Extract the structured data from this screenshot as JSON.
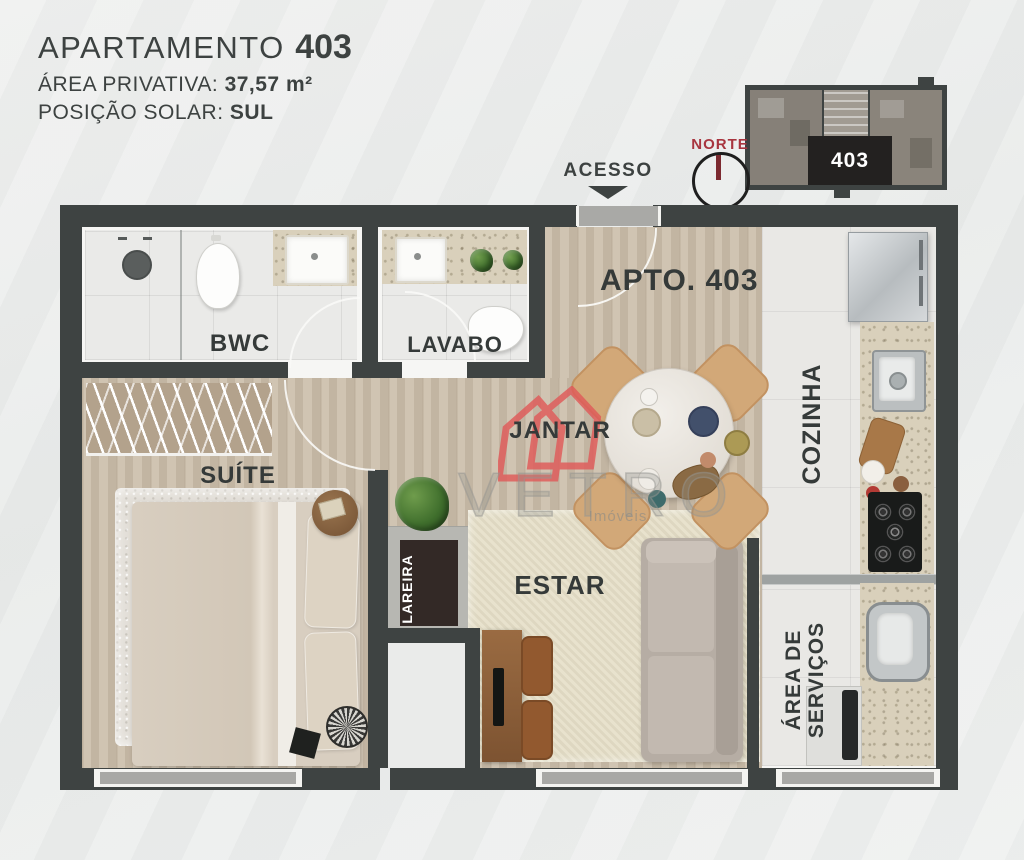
{
  "header": {
    "title": "APARTAMENTO",
    "number": "403",
    "area_label": "ÁREA PRIVATIVA:",
    "area_value": "37,57 m²",
    "solar_label": "POSIÇÃO SOLAR:",
    "solar_value": "SUL"
  },
  "minimap": {
    "unit": "403",
    "compass": "NORTE"
  },
  "plan": {
    "access": "ACESSO",
    "unit_title": "APTO. 403",
    "rooms": {
      "bwc": "BWC",
      "lavabo": "LAVABO",
      "suite": "SUÍTE",
      "jantar": "JANTAR",
      "estar": "ESTAR",
      "cozinha": "COZINHA",
      "lareira": "LAREIRA",
      "servicos1": "ÁREA DE",
      "servicos2": "SERVIÇOS"
    }
  },
  "watermark": {
    "brand": "VETRO",
    "subtitle": "Imóveis"
  },
  "colors": {
    "wall": "#3e4342",
    "brand_red": "#e05a59",
    "north_red": "#a8353f",
    "label_text": "#353a39",
    "wood_floor": "#cbbda9",
    "granite": "#d9d0bb"
  }
}
